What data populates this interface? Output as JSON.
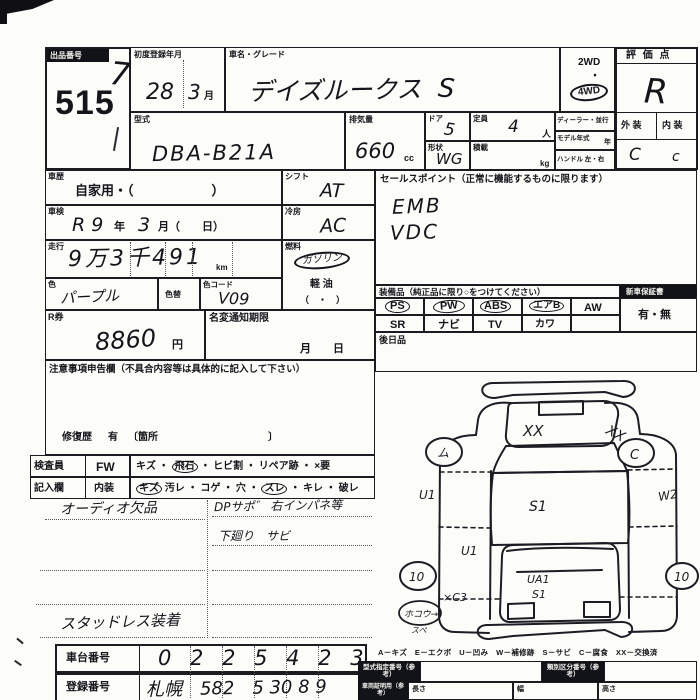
{
  "colors": {
    "ink": "#17181d",
    "paper": "#fcfcf9"
  },
  "misc": {
    "dot": "・"
  },
  "lot": {
    "label": "出品番号",
    "number": "515",
    "hw_mark": "7"
  },
  "header": {
    "first_reg_label": "初度登録年月",
    "first_reg_year": "28",
    "first_reg_month": "3",
    "month_unit": "月",
    "car_name_label": "車名・グレード",
    "car_name_value": "デイズルークス",
    "grade_value": "S",
    "drive_2wd": "2WD",
    "drive_4wd": "4WD",
    "score_label": "評 価 点",
    "score_value": "R",
    "ext_label": "外 装",
    "int_label": "内 装",
    "ext_value": "C",
    "int_value": "c",
    "model_label": "型式",
    "model_value": "DBA-B21A",
    "disp_label": "排気量",
    "disp_value": "660",
    "disp_unit": "cc",
    "door_label": "ドア",
    "door_value": "5",
    "cap_label": "定員",
    "cap_value": "4",
    "cap_unit": "人",
    "shape_label": "形状",
    "shape_value": "WG",
    "load_label": "積載",
    "load_unit": "kg",
    "dealer_label": "ディーラー・並行",
    "model_year_label": "モデル年式",
    "model_year_unit": "年",
    "handle_label": "ハンドル 左・右"
  },
  "mid": {
    "history_label": "車歴",
    "history_value": "自家用・（　　　　　　）",
    "shift_label": "シフト",
    "shift_value": "AT",
    "shaken_label": "車検",
    "shaken_v1": "R 9",
    "shaken_u1": "年",
    "shaken_v2": "3",
    "shaken_u2": "月（　　日）",
    "cool_label": "冷房",
    "cool_value": "AC",
    "mileage_label": "走行",
    "mileage_value": "9万3千491",
    "mileage_unit": "km",
    "fuel_label": "燃料",
    "fuel_opt1": "ガソリン",
    "fuel_opt2": "軽 油",
    "fuel_opt3": "（　・　）",
    "color_label": "色",
    "color_value": "パープル",
    "color_chg_label": "色替",
    "color_code_label": "色コード",
    "color_code_value": "V09",
    "rticket_label": "R券",
    "rticket_value": "8860",
    "rticket_unit": "円",
    "namechg_label": "名変通知期限",
    "namechg_unit": "月　　日",
    "notes_header": "注意事項申告欄（不具合内容等は具体的に記入して下さい）",
    "repair_label": "修復歴",
    "repair_value": "有",
    "repair_loc": "〔箇所　　　　　　　　　　　〕"
  },
  "sales": {
    "header": "セールスポイント（正常に機能するものに限ります）",
    "line1": "EMB",
    "line2": "VDC"
  },
  "equipment": {
    "header": "装備品（純正品に限り○をつけてください）",
    "warranty_label": "新車保証書",
    "warranty_value": "有・無",
    "row1": [
      {
        "label": "PS",
        "circled": true
      },
      {
        "label": "PW",
        "circled": true
      },
      {
        "label": "ABS",
        "circled": true
      },
      {
        "label": "エアB",
        "circled": true
      },
      {
        "label": "AW",
        "circled": false
      }
    ],
    "row2": [
      {
        "label": "SR"
      },
      {
        "label": "ナビ"
      },
      {
        "label": "TV"
      },
      {
        "label": "カワ"
      },
      {
        "label": ""
      }
    ],
    "after_label": "後日品"
  },
  "inspector": {
    "key1": "検査員",
    "key2": "記入欄",
    "sub1": "FW",
    "sub2": "内装",
    "fw_items": [
      {
        "t": "キズ",
        "c": false
      },
      {
        "t": "飛石",
        "c": true
      },
      {
        "t": "ヒビ割",
        "c": false
      },
      {
        "t": "リペア跡",
        "c": false
      },
      {
        "t": "×要",
        "c": false
      }
    ],
    "int_items": [
      {
        "t": "キズ",
        "c": true
      },
      {
        "t": "汚レ",
        "c": false
      },
      {
        "t": "コゲ",
        "c": false
      },
      {
        "t": "穴",
        "c": false
      },
      {
        "t": "スレ",
        "c": true
      },
      {
        "t": "キレ",
        "c": false
      },
      {
        "t": "破レ",
        "c": false
      }
    ],
    "note1": "オーディオ欠品",
    "note2": "DPサポ゛ 右インパネ等",
    "note3": "下廻り　サビ",
    "note4": "スタッドレス装着"
  },
  "diagram": {
    "legend": "A－キズ　E－エクボ　U－凹み　W－補修跡　S－サビ　C－腐食　XX－交換済",
    "hood_mark": "XX",
    "fender_mark": "XX",
    "roof_mark": "S1",
    "door_left_mark": "U1",
    "side_right_mark": "W2",
    "rear_left_mark": "U1",
    "corner_mark": "×C3",
    "hatch_mark1": "UA1",
    "hatch_mark2": "S1",
    "wheel_fl": "ム",
    "wheel_fr": "C",
    "wheel_rl": "10",
    "wheel_rr": "10",
    "note_circle": "ホコウ→",
    "note_below": "スペ"
  },
  "bottom": {
    "chassis_label": "車台番号",
    "chassis_value": "0 2 2 5 4 2 3",
    "reg_label": "登録番号",
    "reg_value": "札幌　582　5 30 8 9",
    "t1_label": "型式指定番号（参考）",
    "t2_label": "類別区分番号（参考）",
    "t3_label": "車両証明用（参考）",
    "len_label": "長さ",
    "wid_label": "幅",
    "hei_label": "高さ"
  }
}
